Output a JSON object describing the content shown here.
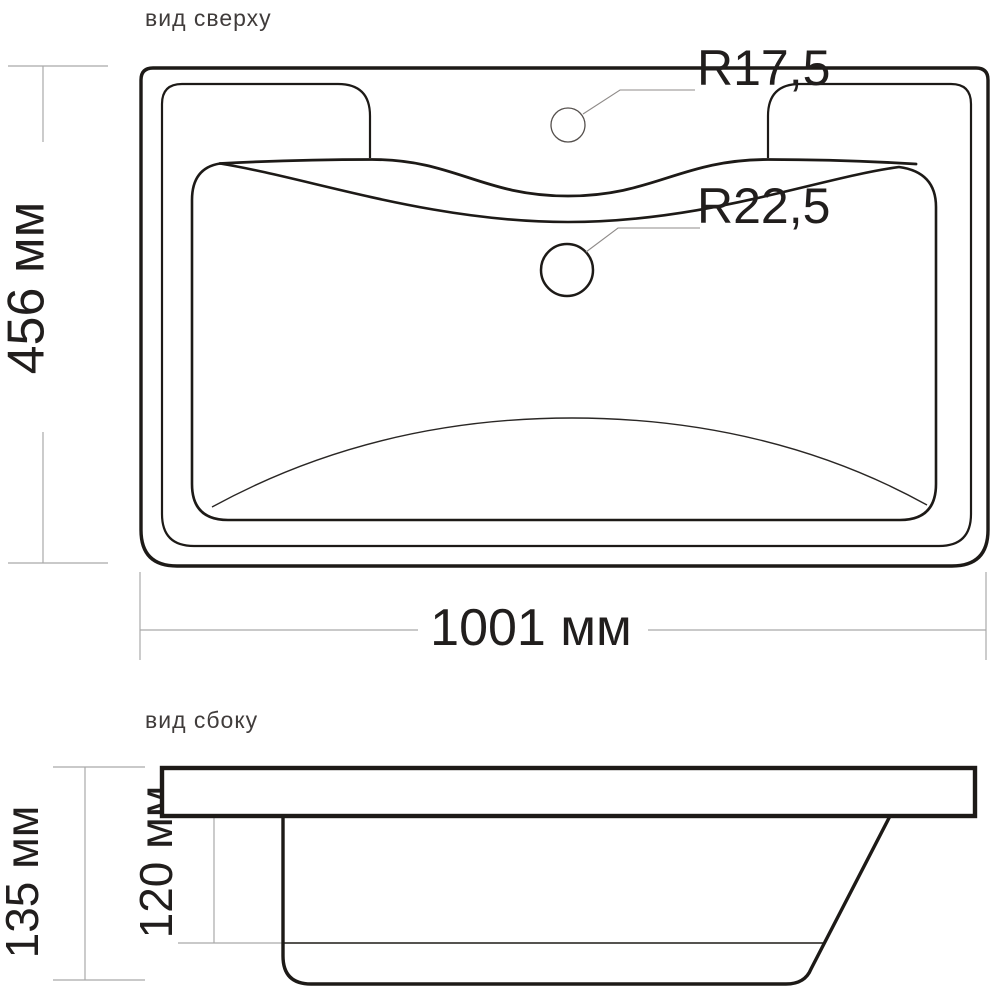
{
  "drawing": {
    "background_color": "#ffffff",
    "line_color": "#1d1a17",
    "dim_line_color": "#a9a9a9",
    "text_color": "#211e1d"
  },
  "top_view": {
    "label": "вид сверху",
    "faucet_hole_radius_label": "R17,5",
    "drain_hole_radius_label": "R22,5",
    "width_dimension": "1001 мм",
    "depth_dimension": "456 мм"
  },
  "side_view": {
    "label": "вид сбоку",
    "total_height_dimension": "135 мм",
    "bowl_depth_dimension": "120 мм"
  }
}
